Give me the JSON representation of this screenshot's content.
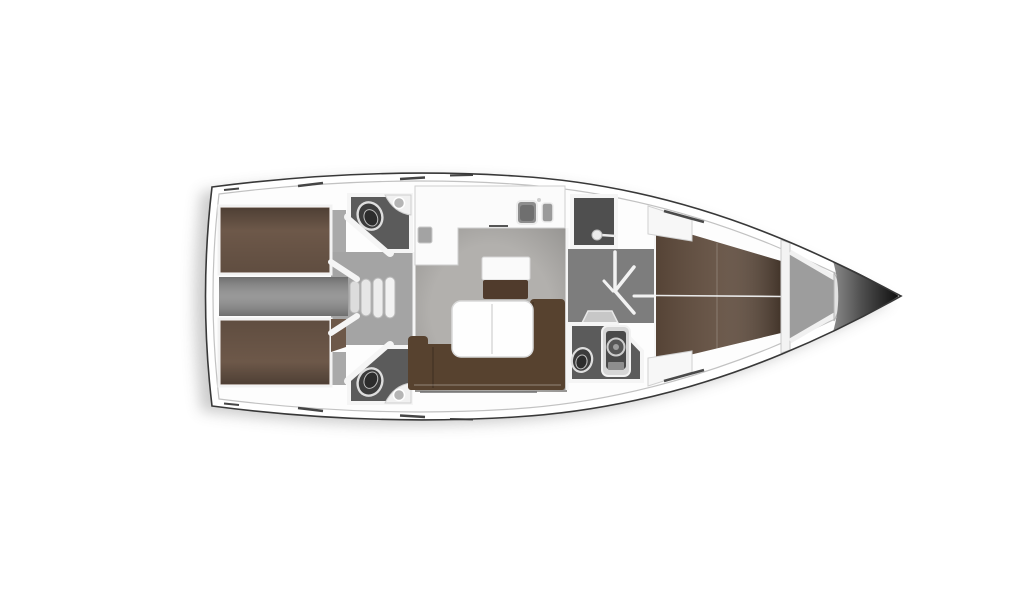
{
  "figure": {
    "kind": "sailboat-interior-floorplan",
    "orientation": "bow-right"
  },
  "colors": {
    "background": "#ffffff",
    "hull_outline": "#383838",
    "inner_hull_line": "#c2c2c2",
    "deck_white": "#fdfdfd",
    "aft_berth_brown": "#6d5849",
    "forward_berth_brown": "#5f4b3c",
    "sofa_brown": "#57422f",
    "bench_brown": "#503b2c",
    "table_white": "#fefefe",
    "salon_floor_gray": "#b2b0ad",
    "corridor_gray": "#8d8d8d",
    "vestibule_gray": "#a4a4a4",
    "passage_gray": "#7d7d7d",
    "cabin_floor_gray": "#a9a9a9",
    "head_floor_gray": "#5b5b5b",
    "shower_floor_gray": "#4f4f4f",
    "anchor_locker_gray": "#9d9d9d",
    "bow_tip_dark": "#0d0d0d",
    "fixture_dark": "#3f3f3f",
    "fixture_light": "#ededed",
    "wall_white": "#f5f5f5",
    "hatch_mark_dark": "#454545"
  },
  "icons": {
    "toilet": "toilet-icon",
    "sink": "sink-icon",
    "double_sink": "galley-sink-icon",
    "shower_head": "shower-head-icon",
    "shower_column": "shower-column-icon",
    "steps": "companionway-steps-icon",
    "door_swing": "door-swing-icon",
    "stove": "stove-icon"
  }
}
